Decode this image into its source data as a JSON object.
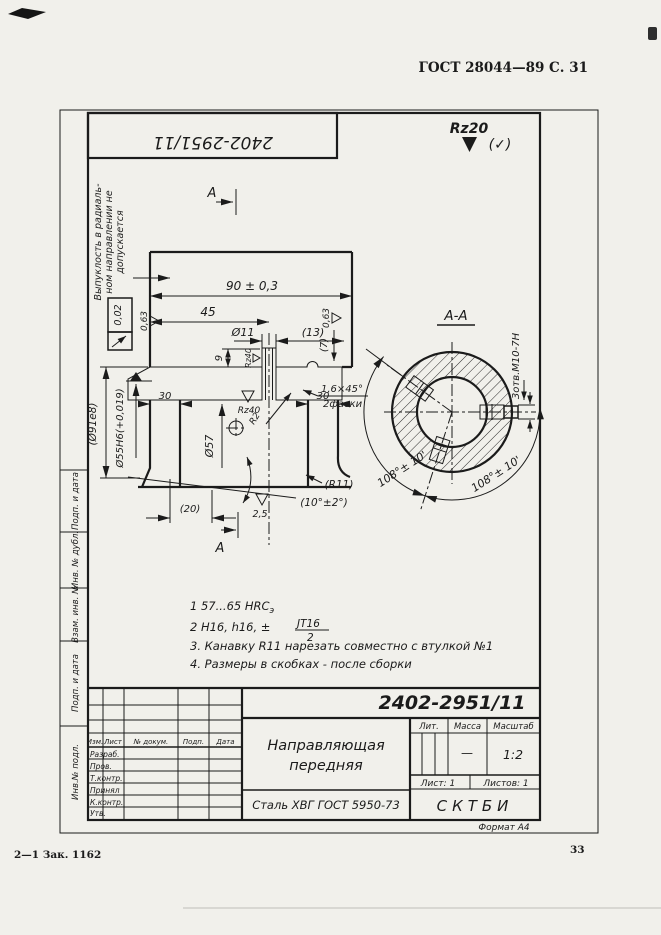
{
  "colors": {
    "paper": "#f1f0eb",
    "ink": "#1b1b1b"
  },
  "header": {
    "gost": "ГОСТ 28044—89 С. 31"
  },
  "footer": {
    "imprint": "2—1 Зак. 1162",
    "page": "33"
  },
  "stamp": {
    "number": "2402-2951/11"
  },
  "roughness": {
    "general": "Rz20",
    "tick": "(✓)",
    "r063_left": "0,63",
    "r063_right": "0,63",
    "r063_bottom": "0,63",
    "r25": "2,5",
    "rz40_hole": "Rz40",
    "rz40_groove": "Rz40"
  },
  "note_left": {
    "line1": "Выпуклость в радиаль-",
    "line2": "ном направлении не",
    "line3": "допускается"
  },
  "tolerance": {
    "value": "0,02"
  },
  "section": {
    "label_top": "А",
    "label_bottom": "А",
    "view_title": "А-А",
    "holes": "3отв.М10-7Н",
    "angle_left": "108°± 10'",
    "angle_right": "108°± 10'"
  },
  "dims": {
    "d90": "90 ± 0,3",
    "d45": "45",
    "d11": "Ø11",
    "d13": "(13)",
    "d9": "9",
    "d7": "(7)",
    "d30_left": "30",
    "d30_right": "30",
    "chamfer1": "1,6×45°",
    "chamfer2": "2фаски",
    "d57": "Ø57",
    "d55": "Ø55Н6(+0,019)",
    "d91": "(Ø91е8)",
    "d20": "(20)",
    "r11": "(R11)",
    "a10": "(10°±2°)",
    "r2": "R2"
  },
  "notes": {
    "n1": "1   57...65 HRC",
    "n1sub": "э",
    "n2": "2   Н16,  h16,  ±",
    "n2num": "JT16",
    "n2den": "2",
    "n3": "3. Канавку  R11  нарезать  совместно  с  втулкой  №1",
    "n4": "4. Размеры  в  скобках - после  сборки"
  },
  "title_block": {
    "number": "2402-2951/11",
    "name1": "Направляющая",
    "name2": "передняя",
    "material": "Сталь ХВГ  ГОСТ 5950-73",
    "org": "СКТБИ",
    "lit": "Лит.",
    "mass": "Масса",
    "scale": "Масштаб",
    "mass_value": "—",
    "scale_value": "1:2",
    "sheet": "Лист: 1",
    "sheets": "Листов: 1",
    "format": "Формат  А4",
    "cols": {
      "izm": "Изм.",
      "list": "Лист",
      "doc": "№ докум.",
      "podp": "Подп.",
      "data": "Дата"
    },
    "rows": [
      "Разраб.",
      "Пров.",
      "Т.контр.",
      "Принял",
      "К.контр.",
      "Утв."
    ]
  },
  "margin": {
    "m1": "Подп. и дата",
    "m2": "Инв. № дубл.",
    "m3": "Взам. инв. №",
    "m4": "Подп. и дата",
    "m5": "Инв.№ подл."
  }
}
